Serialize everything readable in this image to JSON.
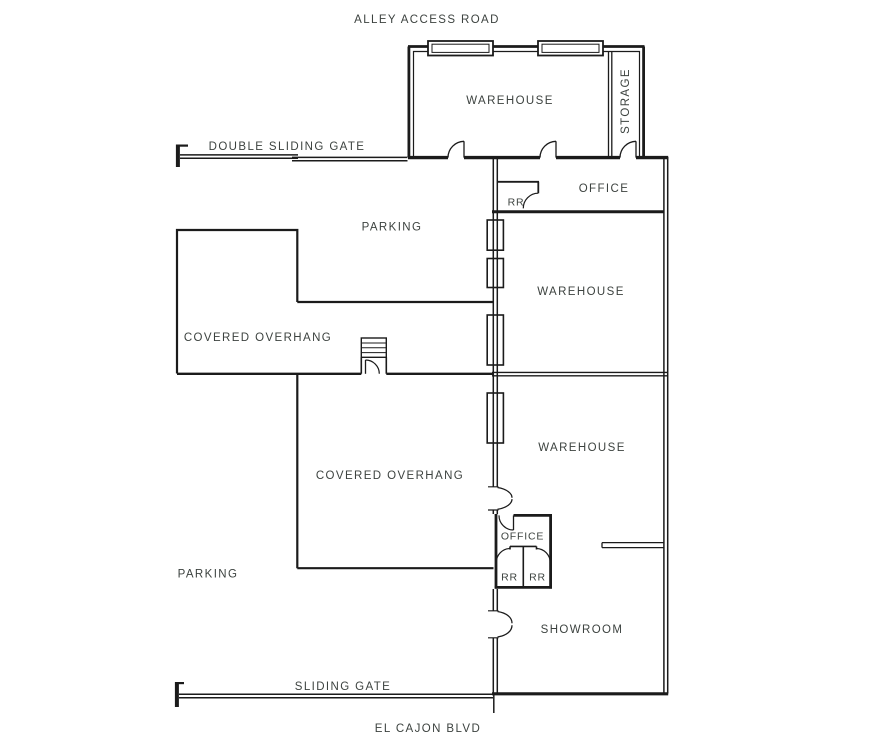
{
  "colors": {
    "line": "#1b1b1b",
    "text": "#3c423f",
    "background": "#ffffff"
  },
  "streets": {
    "top": "ALLEY ACCESS ROAD",
    "bottom": "EL CAJON BLVD"
  },
  "gates": {
    "double_sliding_gate": "DOUBLE SLIDING GATE",
    "sliding_gate": "SLIDING GATE"
  },
  "areas": {
    "parking_upper": "PARKING",
    "parking_lower": "PARKING",
    "covered_overhang_upper": "COVERED OVERHANG",
    "covered_overhang_lower": "COVERED OVERHANG"
  },
  "rooms": {
    "warehouse_top": "WAREHOUSE",
    "storage": "STORAGE",
    "office_upper": "OFFICE",
    "restroom_upper": "RR",
    "warehouse_middle": "WAREHOUSE",
    "warehouse_lower": "WAREHOUSE",
    "office_lower": "OFFICE",
    "restroom_left": "RR",
    "restroom_right": "RR",
    "showroom": "SHOWROOM"
  }
}
